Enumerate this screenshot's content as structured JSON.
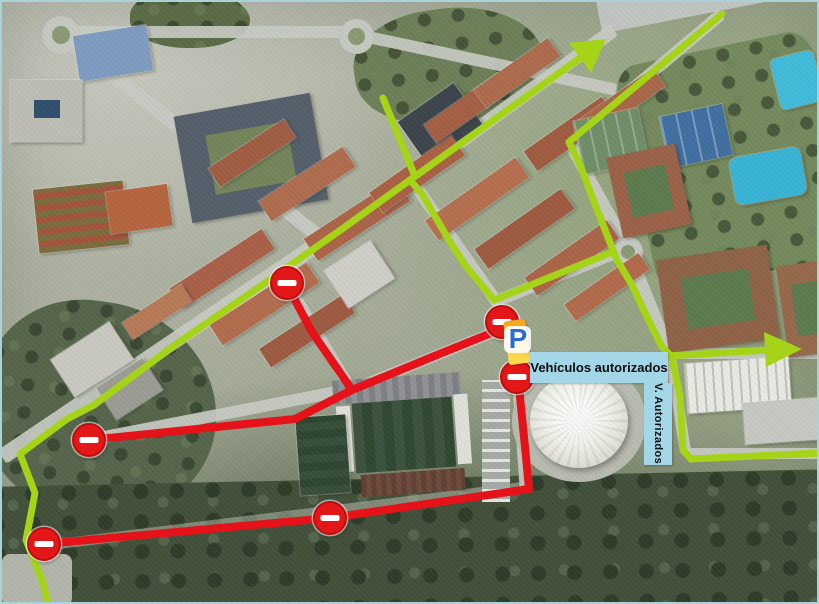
{
  "map": {
    "labels": {
      "authorized_vehicles": "Vehículos autorizados",
      "authorized_vertical": "V. Autorizados",
      "parking_symbol": "P"
    },
    "colors": {
      "allowed_route_green": "#a5d317",
      "restricted_route_red": "#e6121a",
      "no_entry_sign_red": "#e31717",
      "label_background_blue": "#a3d7e8",
      "parking_letter_blue": "#2b6cd4",
      "parking_banner_orange": "#f6a91c"
    },
    "overlay": {
      "green_routes": [
        {
          "name": "avenue-west",
          "points": [
            [
              408,
              178
            ],
            [
              340,
              227
            ],
            [
              250,
              290
            ],
            [
              177,
              340
            ],
            [
              92,
              403
            ],
            [
              65,
              417
            ],
            [
              18,
              452
            ]
          ]
        },
        {
          "name": "left-zigzag-south",
          "points": [
            [
              18,
              452
            ],
            [
              33,
              491
            ],
            [
              24,
              538
            ],
            [
              40,
              578
            ],
            [
              47,
              604
            ]
          ]
        },
        {
          "name": "north-spur",
          "points": [
            [
              381,
              96
            ],
            [
              412,
              172
            ]
          ]
        },
        {
          "name": "northeast-arrow-shaft",
          "points": [
            [
              408,
              178
            ],
            [
              578,
              56
            ]
          ]
        },
        {
          "name": "mid-diagonal",
          "points": [
            [
              408,
              178
            ],
            [
              420,
              192
            ],
            [
              448,
              240
            ],
            [
              463,
              263
            ],
            [
              492,
              298
            ],
            [
              610,
              250
            ]
          ]
        },
        {
          "name": "right-loop",
          "points": [
            [
              720,
              12
            ],
            [
              567,
              140
            ],
            [
              578,
              163
            ],
            [
              594,
              205
            ],
            [
              607,
              238
            ],
            [
              615,
              258
            ],
            [
              630,
              283
            ],
            [
              645,
              315
            ],
            [
              660,
              345
            ],
            [
              668,
              353
            ]
          ]
        },
        {
          "name": "east-arrow-shaft",
          "points": [
            [
              664,
              354
            ],
            [
              768,
              348
            ]
          ]
        },
        {
          "name": "south-branch",
          "points": [
            [
              670,
              355
            ],
            [
              678,
              395
            ],
            [
              681,
              448
            ],
            [
              689,
              457
            ],
            [
              819,
              451
            ]
          ]
        }
      ],
      "green_arrowheads": [
        {
          "name": "arrowhead-northeast",
          "points": [
            [
              604,
              37
            ],
            [
              589,
              71
            ],
            [
              567,
              41
            ]
          ]
        },
        {
          "name": "arrowhead-east",
          "points": [
            [
              800,
              347
            ],
            [
              762,
              330
            ],
            [
              764,
              365
            ]
          ]
        }
      ],
      "red_routes": [
        {
          "name": "west-segment",
          "points": [
            [
              87,
              438
            ],
            [
              293,
              417
            ],
            [
              350,
              388
            ]
          ]
        },
        {
          "name": "north-branch",
          "points": [
            [
              350,
              388
            ],
            [
              310,
              330
            ],
            [
              285,
              283
            ]
          ]
        },
        {
          "name": "to-parking",
          "points": [
            [
              350,
              388
            ],
            [
              430,
              355
            ],
            [
              514,
              321
            ]
          ]
        },
        {
          "name": "parking-vertical",
          "points": [
            [
              510,
              319
            ],
            [
              516,
              375
            ],
            [
              524,
              455
            ],
            [
              527,
              487
            ]
          ]
        },
        {
          "name": "bottom-segment",
          "points": [
            [
              527,
              487
            ],
            [
              328,
              516
            ],
            [
              42,
              542
            ]
          ]
        }
      ],
      "no_entry_signs": [
        {
          "x": 285,
          "y": 281
        },
        {
          "x": 87,
          "y": 438
        },
        {
          "x": 42,
          "y": 542
        },
        {
          "x": 328,
          "y": 516
        },
        {
          "x": 500,
          "y": 320
        },
        {
          "x": 515,
          "y": 375
        }
      ]
    }
  }
}
